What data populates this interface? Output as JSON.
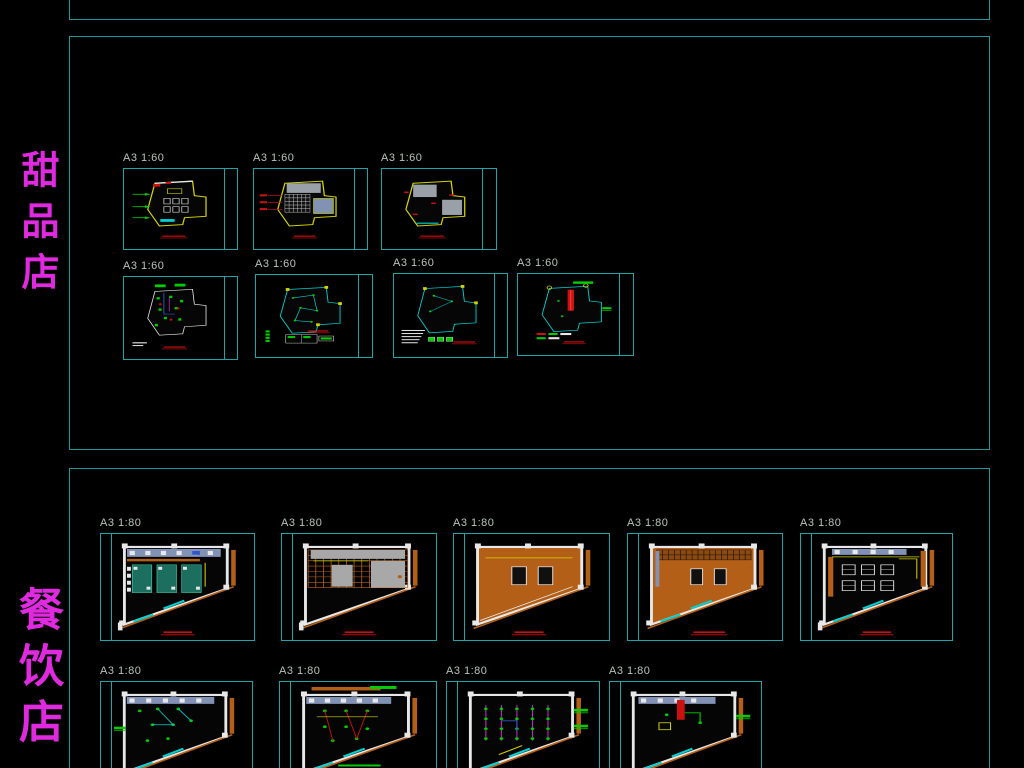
{
  "palette": {
    "teal_border": "#179b9b",
    "frame": "#1ba7a7",
    "label_gray": "#b9c3bb",
    "magenta": "#e02ae0",
    "white": "#e8e8e8",
    "yellow": "#d4d400",
    "green": "#00cc00",
    "red": "#cc1111",
    "cyan": "#00d2d2",
    "orange": "#b45f17",
    "gray": "#9aa0a8",
    "bluegray": "#8292b4",
    "blue": "#3355cc",
    "vmagenta": "#cc22cc"
  },
  "side_labels": [
    {
      "id": "dessert-shop",
      "text": "甜品店",
      "color": "#e02ae0",
      "x": 17,
      "y": 150,
      "font_size": 38,
      "spacing": 13
    },
    {
      "id": "restaurant",
      "text": "餐饮店",
      "color": "#e02ae0",
      "x": 14,
      "y": 586,
      "font_size": 45,
      "spacing": 11
    }
  ],
  "top_strip": {
    "x": 69,
    "y": -12,
    "w": 921,
    "h": 32
  },
  "sections": [
    {
      "id": "dessert-sheets",
      "rect": {
        "x": 69,
        "y": 36,
        "w": 921,
        "h": 414
      },
      "sheets": [
        {
          "label": "A3 1:60",
          "x": 123,
          "y": 168,
          "w": 115,
          "h": 82,
          "kind": "d_furniture",
          "title_side": "right"
        },
        {
          "label": "A3 1:60",
          "x": 253,
          "y": 168,
          "w": 115,
          "h": 82,
          "kind": "d_ceiling",
          "title_side": "right"
        },
        {
          "label": "A3 1:60",
          "x": 381,
          "y": 168,
          "w": 116,
          "h": 82,
          "kind": "d_floor",
          "title_side": "right"
        },
        {
          "label": "A3 1:60",
          "x": 123,
          "y": 276,
          "w": 115,
          "h": 84,
          "kind": "d_electric",
          "title_side": "right"
        },
        {
          "label": "A3 1:60",
          "x": 255,
          "y": 274,
          "w": 118,
          "h": 84,
          "kind": "d_wiring",
          "title_side": "right"
        },
        {
          "label": "A3 1:60",
          "x": 393,
          "y": 273,
          "w": 115,
          "h": 85,
          "kind": "d_switch",
          "title_side": "right"
        },
        {
          "label": "A3 1:60",
          "x": 517,
          "y": 273,
          "w": 117,
          "h": 83,
          "kind": "d_fire",
          "title_side": "right"
        }
      ]
    },
    {
      "id": "restaurant-sheets",
      "rect": {
        "x": 69,
        "y": 468,
        "w": 921,
        "h": 330
      },
      "sheets": [
        {
          "label": "A3 1:80",
          "x": 100,
          "y": 533,
          "w": 155,
          "h": 108,
          "kind": "c_layout",
          "title_side": "left"
        },
        {
          "label": "A3 1:80",
          "x": 281,
          "y": 533,
          "w": 156,
          "h": 108,
          "kind": "c_ceiling",
          "title_side": "left"
        },
        {
          "label": "A3 1:80",
          "x": 453,
          "y": 533,
          "w": 157,
          "h": 108,
          "kind": "c_floor1",
          "title_side": "left"
        },
        {
          "label": "A3 1:80",
          "x": 627,
          "y": 533,
          "w": 156,
          "h": 108,
          "kind": "c_floor2",
          "title_side": "left"
        },
        {
          "label": "A3 1:80",
          "x": 800,
          "y": 533,
          "w": 153,
          "h": 108,
          "kind": "c_furniture",
          "title_side": "left"
        },
        {
          "label": "A3 1:80",
          "x": 100,
          "y": 681,
          "w": 153,
          "h": 108,
          "kind": "c_elec1",
          "title_side": "left"
        },
        {
          "label": "A3 1:80",
          "x": 279,
          "y": 681,
          "w": 158,
          "h": 108,
          "kind": "c_elec2",
          "title_side": "left"
        },
        {
          "label": "A3 1:80",
          "x": 446,
          "y": 681,
          "w": 154,
          "h": 108,
          "kind": "c_elec3",
          "title_side": "left"
        },
        {
          "label": "A3 1:80",
          "x": 609,
          "y": 681,
          "w": 153,
          "h": 108,
          "kind": "c_elec4",
          "title_side": "left"
        }
      ]
    }
  ]
}
